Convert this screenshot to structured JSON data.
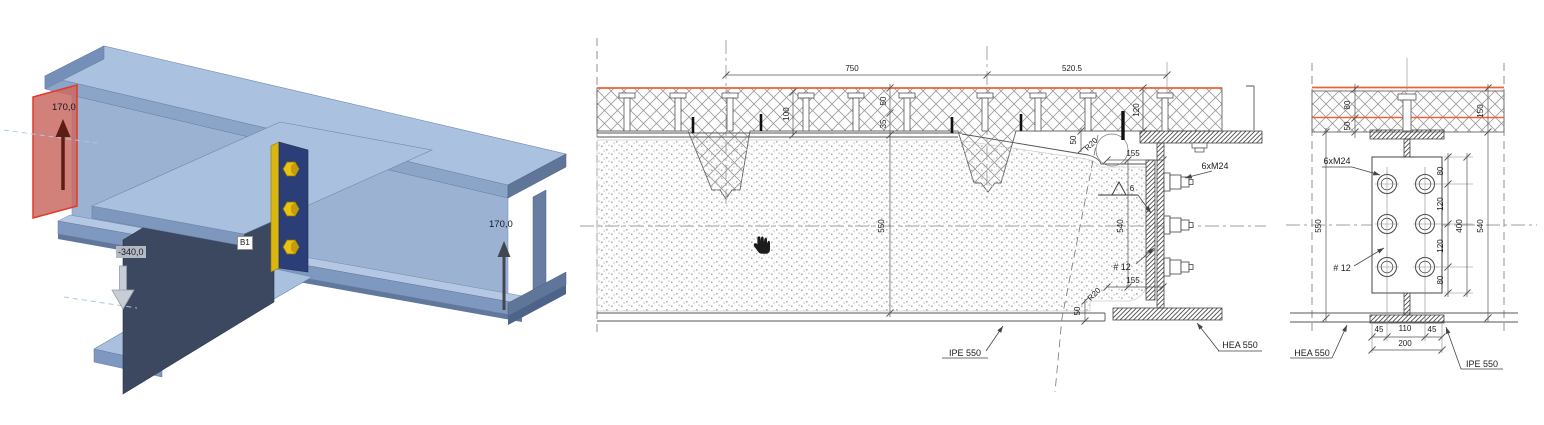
{
  "scene": {
    "background": "#ffffff"
  },
  "colors": {
    "steel_light": "#aac1df",
    "steel_mid": "#8ba5c9",
    "steel_web": "#9cb2d3",
    "steel_dark_web": "#3b4860",
    "bolt_yellow": "#e9c215",
    "end_plate_blue": "#2b3e77",
    "section_plane_red": "#e23a28",
    "slab_top_orange": "#ef6038",
    "drawing_line": "#555555"
  },
  "viewport3d": {
    "labels": {
      "start_offset": "170,0",
      "end_offset": "170,0",
      "vertical_offset": "-340,0",
      "beam_tag": "B1"
    }
  },
  "middle_section": {
    "annotations": [
      {
        "name": "dim-750",
        "text": "750",
        "x": 852,
        "y": 71
      },
      {
        "name": "dim-520p5",
        "text": "520.5",
        "x": 1072,
        "y": 71
      },
      {
        "name": "dim-100",
        "text": "100",
        "x": 789,
        "y": 114,
        "rot": -90
      },
      {
        "name": "dim-50-topping",
        "text": "50",
        "x": 886,
        "y": 101,
        "rot": -90
      },
      {
        "name": "dim-35-deck",
        "text": "35",
        "x": 886,
        "y": 124,
        "rot": -90
      },
      {
        "name": "dim-550-beam-depth",
        "text": "550",
        "x": 884,
        "y": 226,
        "rot": -90
      },
      {
        "name": "dim-120-notch",
        "text": "120",
        "x": 1139,
        "y": 110,
        "rot": -90
      },
      {
        "name": "dim-50-notch",
        "text": "50",
        "x": 1076,
        "y": 140,
        "rot": -90
      },
      {
        "name": "radius-R20-top",
        "text": "R20",
        "x": 1093,
        "y": 146,
        "rot": -45
      },
      {
        "name": "dim-155-top",
        "text": "155",
        "x": 1133,
        "y": 156
      },
      {
        "name": "dim-540-bolt-pitch",
        "text": "540",
        "x": 1123,
        "y": 226,
        "rot": -90
      },
      {
        "name": "dim-155-bottom",
        "text": "155",
        "x": 1133,
        "y": 283
      },
      {
        "name": "radius-R20-bottom",
        "text": "R20",
        "x": 1096,
        "y": 296,
        "rot": -45
      },
      {
        "name": "dim-50-bottom-notch",
        "text": "50",
        "x": 1080,
        "y": 311,
        "rot": -90
      },
      {
        "name": "weld-size-6",
        "text": "6",
        "x": 1132,
        "y": 191
      },
      {
        "name": "plate-thickness-12",
        "text": "# 12",
        "x": 1122,
        "y": 270,
        "fs": 9
      },
      {
        "name": "bolt-spec-6xM24",
        "text": "6xM24",
        "x": 1215,
        "y": 169,
        "fs": 9
      },
      {
        "name": "label-IPE550",
        "text": "IPE 550",
        "x": 965,
        "y": 356,
        "fs": 9
      },
      {
        "name": "label-HEA550",
        "text": "HEA 550",
        "x": 1240,
        "y": 348,
        "fs": 9
      }
    ]
  },
  "end_section": {
    "annotations": [
      {
        "name": "dim-80-slab",
        "text": "80",
        "x": 1350,
        "y": 105,
        "rot": -90
      },
      {
        "name": "dim-50-slab",
        "text": "50",
        "x": 1350,
        "y": 126,
        "rot": -90
      },
      {
        "name": "dim-150-slab",
        "text": "150",
        "x": 1483,
        "y": 111,
        "rot": -90
      },
      {
        "name": "dim-550-beam-depth",
        "text": "550",
        "x": 1321,
        "y": 226,
        "rot": -90
      },
      {
        "name": "dim-80-edge-top",
        "text": "80",
        "x": 1443,
        "y": 171,
        "rot": -90
      },
      {
        "name": "dim-120-pitch-top",
        "text": "120",
        "x": 1443,
        "y": 204,
        "rot": -90
      },
      {
        "name": "dim-120-pitch-bottom",
        "text": "120",
        "x": 1443,
        "y": 246,
        "rot": -90
      },
      {
        "name": "dim-80-edge-bottom",
        "text": "80",
        "x": 1443,
        "y": 280,
        "rot": -90
      },
      {
        "name": "dim-400-bolt-group",
        "text": "400",
        "x": 1462,
        "y": 226,
        "rot": -90
      },
      {
        "name": "dim-540-plate",
        "text": "540",
        "x": 1483,
        "y": 226,
        "rot": -90
      },
      {
        "name": "dim-45-left",
        "text": "45",
        "x": 1379,
        "y": 332
      },
      {
        "name": "dim-110-gauge",
        "text": "110",
        "x": 1405,
        "y": 331
      },
      {
        "name": "dim-45-right",
        "text": "45",
        "x": 1432,
        "y": 332
      },
      {
        "name": "dim-200-plate-width",
        "text": "200",
        "x": 1405,
        "y": 346
      },
      {
        "name": "bolt-spec-6xM24",
        "text": "6xM24",
        "x": 1337,
        "y": 164,
        "fs": 9
      },
      {
        "name": "plate-thickness-12",
        "text": "# 12",
        "x": 1342,
        "y": 271,
        "fs": 9
      },
      {
        "name": "label-HEA550",
        "text": "HEA 550",
        "x": 1312,
        "y": 356,
        "fs": 9
      },
      {
        "name": "label-IPE550",
        "text": "IPE 550",
        "x": 1482,
        "y": 367,
        "fs": 9
      }
    ]
  }
}
